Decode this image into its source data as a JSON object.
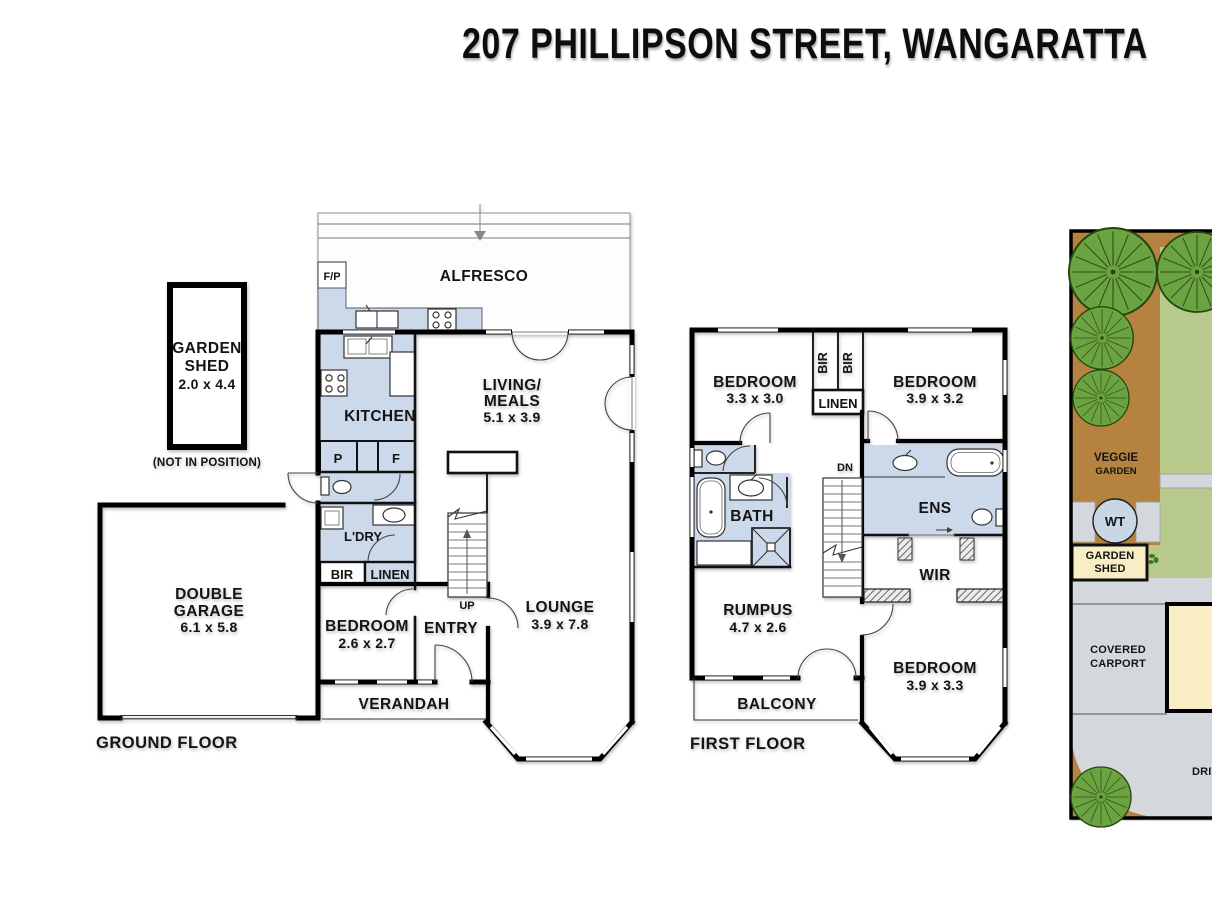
{
  "title": "207 PHILLIPSON STREET, WANGARATTA",
  "ground_floor": {
    "floor_label": "GROUND FLOOR",
    "garden_shed": {
      "name_line1": "GARDEN",
      "name_line2": "SHED",
      "dims": "2.0 x 4.4",
      "note": "(NOT IN POSITION)"
    },
    "alfresco": {
      "label": "ALFRESCO"
    },
    "fireplace": {
      "label": "F/P"
    },
    "kitchen": {
      "label": "KITCHEN"
    },
    "pantry": {
      "label": "P"
    },
    "fridge": {
      "label": "F"
    },
    "laundry": {
      "label": "L'DRY"
    },
    "bir": {
      "label": "BIR"
    },
    "linen": {
      "label": "LINEN"
    },
    "living_meals": {
      "name_line1": "LIVING/",
      "name_line2": "MEALS",
      "dims": "5.1 x 3.9"
    },
    "lounge": {
      "name": "LOUNGE",
      "dims": "3.9 x 7.8"
    },
    "bedroom": {
      "name": "BEDROOM",
      "dims": "2.6 x 2.7"
    },
    "entry": {
      "label": "ENTRY"
    },
    "stairs": {
      "label": "UP"
    },
    "verandah": {
      "label": "VERANDAH"
    },
    "garage": {
      "name_line1": "DOUBLE",
      "name_line2": "GARAGE",
      "dims": "6.1 x 5.8"
    }
  },
  "first_floor": {
    "floor_label": "FIRST FLOOR",
    "bedroom_front": {
      "name": "BEDROOM",
      "dims": "3.3 x 3.0"
    },
    "bedroom_rear": {
      "name": "BEDROOM",
      "dims": "3.9 x 3.2"
    },
    "bedroom_bay": {
      "name": "BEDROOM",
      "dims": "3.9 x 3.3"
    },
    "bir_left": {
      "label": "BIR"
    },
    "bir_right": {
      "label": "BIR"
    },
    "linen": {
      "label": "LINEN"
    },
    "bath": {
      "label": "BATH"
    },
    "stairs": {
      "label": "DN"
    },
    "ensuite": {
      "label": "ENS"
    },
    "wir": {
      "label": "WIR"
    },
    "rumpus": {
      "name": "RUMPUS",
      "dims": "4.7 x 2.6"
    },
    "balcony": {
      "label": "BALCONY"
    }
  },
  "site_plan": {
    "veggie_garden": {
      "line1": "VEGGIE",
      "line2": "GARDEN"
    },
    "water_tank": {
      "label": "WT"
    },
    "garden_shed": {
      "line1": "GARDEN",
      "line2": "SHED"
    },
    "carport": {
      "line1": "COVERED",
      "line2": "CARPORT"
    },
    "driveway": {
      "label": "DRIVEWAY"
    }
  },
  "colors": {
    "wet_area_blue": "#ccd9ea",
    "garden_bed_brown": "#b5833f",
    "lawn_green": "#b7ca8b",
    "tree_green": "#6ca342",
    "paving_grey": "#d4d8dc",
    "building_cream": "#f8edc5",
    "wall_black": "#000000"
  }
}
